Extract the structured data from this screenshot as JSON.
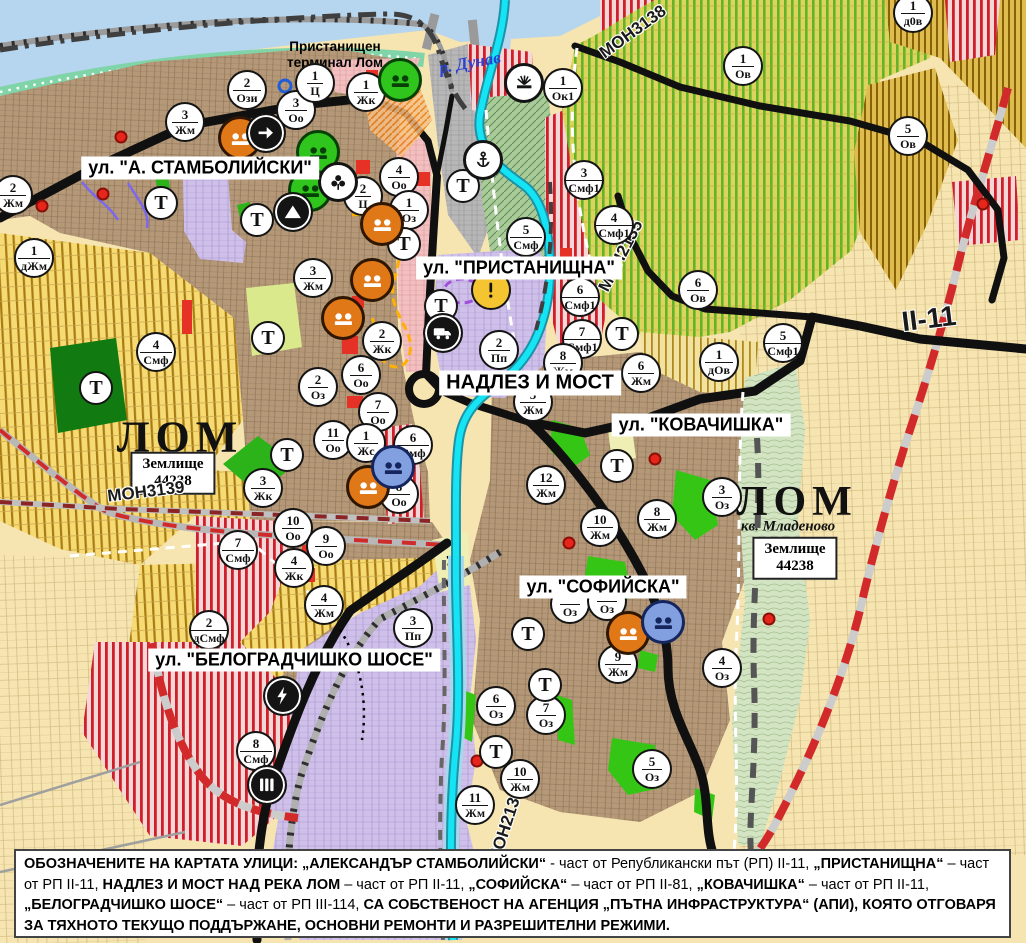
{
  "map_title": "Общ устройствен план - гр. Лом",
  "water_label": "р. Дунав",
  "terminal_label": "Пристанищен\nтерминал Лом",
  "city_labels": [
    {
      "text": "ЛОМ",
      "x": 180,
      "y": 437,
      "size": 44
    },
    {
      "text": "ЛОМ",
      "x": 797,
      "y": 502,
      "size": 42
    }
  ],
  "kvartal_label": {
    "text": "кв. Младеново",
    "x": 788,
    "y": 527
  },
  "zemlishte_boxes": [
    {
      "line1": "Землище",
      "line2": "44238",
      "x": 173,
      "y": 473
    },
    {
      "line1": "Землище",
      "line2": "44238",
      "x": 795,
      "y": 558
    }
  ],
  "street_labels": [
    {
      "text": "ул. \"А. СТАМБОЛИЙСКИ\"",
      "x": 200,
      "y": 168,
      "size": 18
    },
    {
      "text": "ул. \"ПРИСТАНИЩНА\"",
      "x": 519,
      "y": 268,
      "size": 18
    },
    {
      "text": "НАДЛЕЗ И МОСТ",
      "x": 530,
      "y": 383,
      "size": 20
    },
    {
      "text": "ул. \"КОВАЧИШКА\"",
      "x": 701,
      "y": 425,
      "size": 18
    },
    {
      "text": "ул. \"СОФИЙСКА\"",
      "x": 603,
      "y": 587,
      "size": 18
    },
    {
      "text": "ул. \"БЕЛОГРАДЧИШКО ШОСЕ\"",
      "x": 294,
      "y": 660,
      "size": 18
    }
  ],
  "road_labels": [
    {
      "text": "МОН3139",
      "x": 146,
      "y": 492,
      "rot": -7,
      "size": 17
    },
    {
      "text": "МОН3138",
      "x": 633,
      "y": 32,
      "rot": -36,
      "size": 17
    },
    {
      "text": "МОН2135",
      "x": 621,
      "y": 256,
      "rot": -63,
      "size": 17
    },
    {
      "text": "МОН2136",
      "x": 506,
      "y": 826,
      "rot": -72,
      "size": 17
    },
    {
      "text": "II-11",
      "x": 929,
      "y": 319,
      "rot": -7,
      "size": 28
    }
  ],
  "t_label": "Т",
  "zone_markers": [
    {
      "x": 247,
      "y": 90,
      "n": "2",
      "c": "Ози"
    },
    {
      "x": 296,
      "y": 110,
      "n": "3",
      "c": "Оо"
    },
    {
      "x": 315,
      "y": 83,
      "n": "1",
      "c": "Ц"
    },
    {
      "x": 366,
      "y": 92,
      "n": "1",
      "c": "Жк"
    },
    {
      "x": 563,
      "y": 88,
      "n": "1",
      "c": "Ок1"
    },
    {
      "x": 185,
      "y": 122,
      "n": "3",
      "c": "Жм"
    },
    {
      "x": 13,
      "y": 195,
      "n": "2",
      "c": "Жм"
    },
    {
      "x": 399,
      "y": 177,
      "n": "4",
      "c": "Оо"
    },
    {
      "x": 363,
      "y": 196,
      "n": "2",
      "c": "Ц"
    },
    {
      "x": 409,
      "y": 210,
      "n": "1",
      "c": "Оз"
    },
    {
      "x": 584,
      "y": 180,
      "n": "3",
      "c": "Смф1"
    },
    {
      "x": 614,
      "y": 225,
      "n": "4",
      "c": "Смф1"
    },
    {
      "x": 526,
      "y": 237,
      "n": "5",
      "c": "Смф"
    },
    {
      "x": 580,
      "y": 297,
      "n": "6",
      "c": "Смф1"
    },
    {
      "x": 582,
      "y": 339,
      "n": "7",
      "c": "Смф1"
    },
    {
      "x": 499,
      "y": 350,
      "n": "2",
      "c": "Пп"
    },
    {
      "x": 313,
      "y": 278,
      "n": "3",
      "c": "Жм"
    },
    {
      "x": 34,
      "y": 258,
      "n": "1",
      "c": "дЖм"
    },
    {
      "x": 156,
      "y": 352,
      "n": "4",
      "c": "Смф"
    },
    {
      "x": 382,
      "y": 341,
      "n": "2",
      "c": "Жк"
    },
    {
      "x": 361,
      "y": 375,
      "n": "6",
      "c": "Оо"
    },
    {
      "x": 318,
      "y": 387,
      "n": "2",
      "c": "Оз"
    },
    {
      "x": 378,
      "y": 412,
      "n": "7",
      "c": "Оо"
    },
    {
      "x": 333,
      "y": 440,
      "n": "11",
      "c": "Оо"
    },
    {
      "x": 366,
      "y": 443,
      "n": "1",
      "c": "Жс"
    },
    {
      "x": 413,
      "y": 445,
      "n": "6",
      "c": "Смф"
    },
    {
      "x": 399,
      "y": 494,
      "n": "8",
      "c": "Оо"
    },
    {
      "x": 563,
      "y": 363,
      "n": "8",
      "c": "Жм"
    },
    {
      "x": 533,
      "y": 402,
      "n": "5",
      "c": "Жм"
    },
    {
      "x": 641,
      "y": 373,
      "n": "6",
      "c": "Жм"
    },
    {
      "x": 546,
      "y": 485,
      "n": "12",
      "c": "Жм"
    },
    {
      "x": 600,
      "y": 527,
      "n": "10",
      "c": "Жм"
    },
    {
      "x": 657,
      "y": 519,
      "n": "8",
      "c": "Жм"
    },
    {
      "x": 722,
      "y": 497,
      "n": "3",
      "c": "Оз"
    },
    {
      "x": 743,
      "y": 66,
      "n": "1",
      "c": "Ов"
    },
    {
      "x": 908,
      "y": 136,
      "n": "5",
      "c": "Ов"
    },
    {
      "x": 913,
      "y": 13,
      "n": "1",
      "c": "д0в"
    },
    {
      "x": 698,
      "y": 290,
      "n": "6",
      "c": "Ов"
    },
    {
      "x": 783,
      "y": 343,
      "n": "5",
      "c": "Смф1"
    },
    {
      "x": 719,
      "y": 362,
      "n": "1",
      "c": "дОв"
    },
    {
      "x": 263,
      "y": 488,
      "n": "3",
      "c": "Жк"
    },
    {
      "x": 293,
      "y": 528,
      "n": "10",
      "c": "Оо"
    },
    {
      "x": 326,
      "y": 546,
      "n": "9",
      "c": "Оо"
    },
    {
      "x": 238,
      "y": 550,
      "n": "7",
      "c": "Смф"
    },
    {
      "x": 294,
      "y": 568,
      "n": "4",
      "c": "Жк"
    },
    {
      "x": 324,
      "y": 605,
      "n": "4",
      "c": "Жм"
    },
    {
      "x": 209,
      "y": 630,
      "n": "2",
      "c": "дСмф"
    },
    {
      "x": 413,
      "y": 628,
      "n": "3",
      "c": "Пп"
    },
    {
      "x": 256,
      "y": 751,
      "n": "8",
      "c": "Смф"
    },
    {
      "x": 570,
      "y": 604,
      "n": "",
      "c": "Оз"
    },
    {
      "x": 607,
      "y": 601,
      "n": "",
      "c": "Оз"
    },
    {
      "x": 618,
      "y": 664,
      "n": "9",
      "c": "Жм"
    },
    {
      "x": 722,
      "y": 668,
      "n": "4",
      "c": "Оз"
    },
    {
      "x": 496,
      "y": 706,
      "n": "6",
      "c": "Оз"
    },
    {
      "x": 546,
      "y": 715,
      "n": "7",
      "c": "Оз"
    },
    {
      "x": 652,
      "y": 769,
      "n": "5",
      "c": "Оз"
    },
    {
      "x": 520,
      "y": 779,
      "n": "10",
      "c": "Жм"
    },
    {
      "x": 475,
      "y": 805,
      "n": "11",
      "c": "Жм"
    }
  ],
  "transport_markers": [
    {
      "x": 161,
      "y": 203
    },
    {
      "x": 257,
      "y": 220
    },
    {
      "x": 404,
      "y": 244
    },
    {
      "x": 463,
      "y": 186
    },
    {
      "x": 441,
      "y": 306
    },
    {
      "x": 622,
      "y": 334
    },
    {
      "x": 287,
      "y": 455
    },
    {
      "x": 96,
      "y": 388
    },
    {
      "x": 268,
      "y": 338
    },
    {
      "x": 617,
      "y": 466
    },
    {
      "x": 528,
      "y": 634
    },
    {
      "x": 545,
      "y": 685
    },
    {
      "x": 496,
      "y": 752
    }
  ],
  "icon_markers": [
    {
      "x": 240,
      "y": 138,
      "icon": "monument",
      "style": "orange"
    },
    {
      "x": 382,
      "y": 224,
      "icon": "monument",
      "style": "orange"
    },
    {
      "x": 372,
      "y": 280,
      "icon": "monument",
      "style": "orange"
    },
    {
      "x": 343,
      "y": 318,
      "icon": "monument",
      "style": "orange"
    },
    {
      "x": 368,
      "y": 487,
      "icon": "monument",
      "style": "orange"
    },
    {
      "x": 628,
      "y": 633,
      "icon": "monument",
      "style": "orange"
    },
    {
      "x": 393,
      "y": 467,
      "icon": "monument",
      "style": "blue"
    },
    {
      "x": 663,
      "y": 622,
      "icon": "monument",
      "style": "blue"
    },
    {
      "x": 400,
      "y": 80,
      "icon": "monument",
      "style": "green"
    },
    {
      "x": 318,
      "y": 152,
      "icon": "monument",
      "style": "green"
    },
    {
      "x": 310,
      "y": 190,
      "icon": "monument",
      "style": "green"
    },
    {
      "x": 266,
      "y": 133,
      "icon": "arrow",
      "style": "black"
    },
    {
      "x": 293,
      "y": 212,
      "icon": "triangle",
      "style": "black"
    },
    {
      "x": 338,
      "y": 182,
      "icon": "trefoil",
      "style": "white"
    },
    {
      "x": 483,
      "y": 160,
      "icon": "anchor",
      "style": "white"
    },
    {
      "x": 524,
      "y": 83,
      "icon": "sun",
      "style": "white"
    },
    {
      "x": 491,
      "y": 290,
      "icon": "exclamation",
      "style": "yellow"
    },
    {
      "x": 443,
      "y": 333,
      "icon": "truck",
      "style": "black"
    },
    {
      "x": 283,
      "y": 696,
      "icon": "lightning",
      "style": "black"
    },
    {
      "x": 267,
      "y": 785,
      "icon": "railway",
      "style": "black"
    }
  ],
  "dots": [
    {
      "x": 121,
      "y": 137,
      "type": "red"
    },
    {
      "x": 103,
      "y": 194,
      "type": "red"
    },
    {
      "x": 42,
      "y": 206,
      "type": "red"
    },
    {
      "x": 655,
      "y": 459,
      "type": "red"
    },
    {
      "x": 569,
      "y": 543,
      "type": "red"
    },
    {
      "x": 477,
      "y": 761,
      "type": "red"
    },
    {
      "x": 769,
      "y": 619,
      "type": "red"
    },
    {
      "x": 983,
      "y": 204,
      "type": "red"
    },
    {
      "x": 285,
      "y": 86,
      "type": "blue"
    }
  ],
  "footnote_segments": [
    {
      "text": "ОБОЗНАЧЕНИТЕ НА КАРТАТА УЛИЦИ: „АЛЕКСАНДЪР СТАМБОЛИЙСКИ“",
      "bold": true
    },
    {
      "text": " - част от Републикански път (РП) II-11, ",
      "bold": false
    },
    {
      "text": "„ПРИСТАНИЩНА“",
      "bold": true
    },
    {
      "text": " – част от РП II-11, ",
      "bold": false
    },
    {
      "text": "НАДЛЕЗ И МОСТ НАД РЕКА ЛОМ",
      "bold": true
    },
    {
      "text": " – част от РП II-11, ",
      "bold": false
    },
    {
      "text": "„СОФИЙСКА“",
      "bold": true
    },
    {
      "text": " – част от РП II-81, ",
      "bold": false
    },
    {
      "text": "„КОВАЧИШКА“",
      "bold": true
    },
    {
      "text": " – част от РП II-11, ",
      "bold": false
    },
    {
      "text": "„БЕЛОГРАДЧИШКО ШОСЕ“",
      "bold": true
    },
    {
      "text": " – част от РП III-114, ",
      "bold": false
    },
    {
      "text": "СА СОБСТВЕНОСТ НА АГЕНЦИЯ „ПЪТНА ИНФРАСТРУКТУРА“ (АПИ), КОЯТО ОТГОВАРЯ ЗА ТЯХНОТО ТЕКУЩО ПОДДЪРЖАНЕ, ОСНОВНИ РЕМОНТИ И РАЗРЕШИТЕЛНИ РЕЖИМИ.",
      "bold": true
    }
  ],
  "colors": {
    "river": "#b6d5ee",
    "shore": "#7fd4a8",
    "urban_brown": "#b49878",
    "agri_yellow": "#f6da74",
    "vineyard_green": "#61b32a",
    "smf_red": "#cf1f2a",
    "lavender": "#cfc0ea",
    "port_gray": "#b7b7b7",
    "channel_cyan": "#14e4f4",
    "ring_road_red": "#d22a2a",
    "road_black": "#101010",
    "marker_orange": "#e07818",
    "marker_green": "#2fc51c",
    "marker_blue": "#82a0e0"
  }
}
